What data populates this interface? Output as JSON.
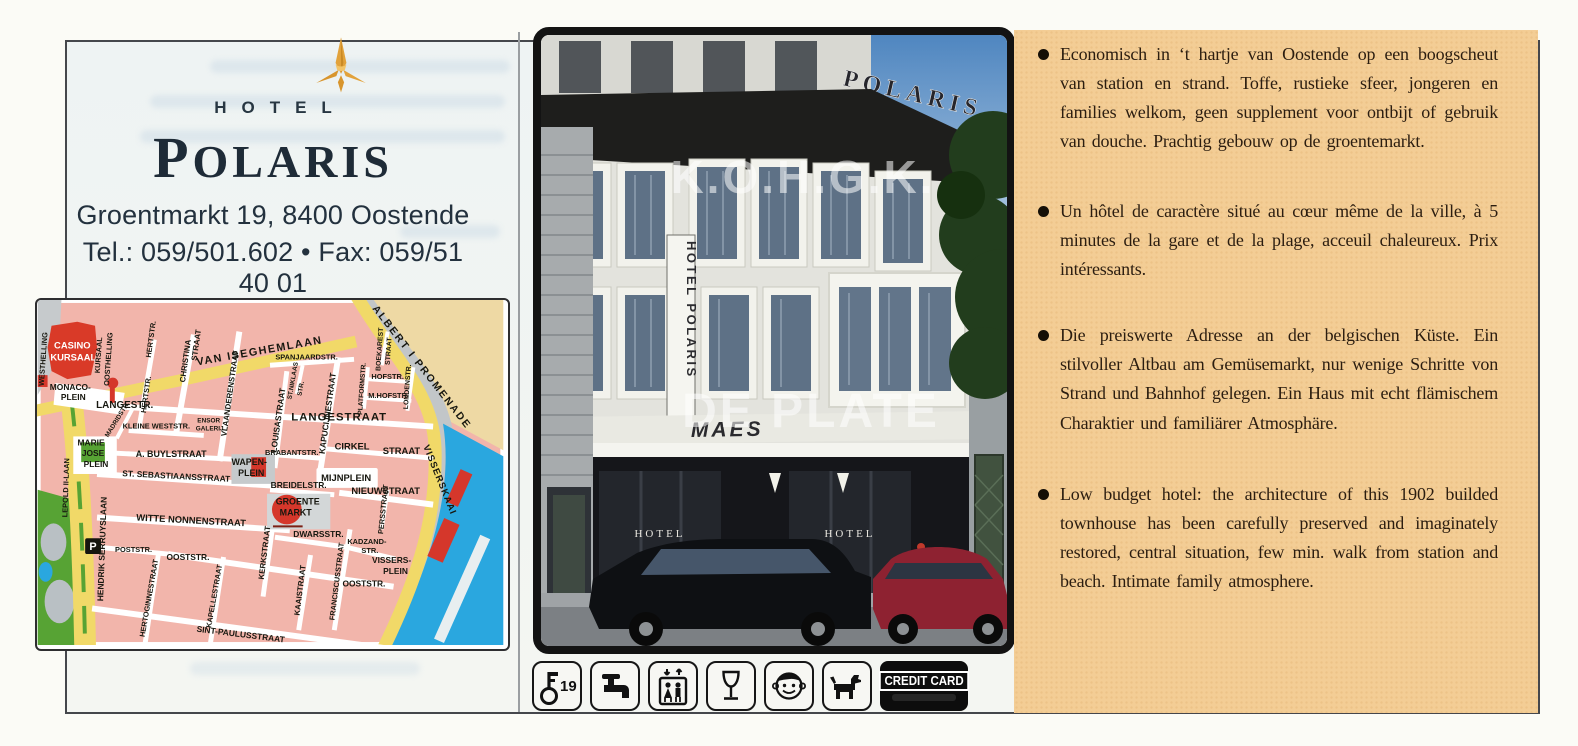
{
  "page": {
    "background": "#fbfbf6",
    "border_color": "#45474c",
    "inner_background": "#f1f5f3"
  },
  "brand": {
    "logo": "gold-star-logo",
    "hotel_label": "HOTEL",
    "name": "POLARIS",
    "address": "Groentmarkt 19, 8400 Oostende",
    "phone_fax": "Tel.: 059/501.602 • Fax: 059/51 40 01",
    "accent_gold": "#e2a23b",
    "navy": "#22303d"
  },
  "map": {
    "colors": {
      "block_pink": "#f2b5ab",
      "road_yellow": "#f1d968",
      "water_blue": "#2aa7df",
      "park_green": "#57a334",
      "landmark_red": "#d5372b",
      "beach_sand": "#eed9a4",
      "promenade_grey": "#c2c6c8"
    },
    "labels": [
      {
        "t": "CASINO",
        "x": 35,
        "y": 49,
        "s": 9.5,
        "c": "#fff"
      },
      {
        "t": "KURSAAL",
        "x": 36,
        "y": 61,
        "s": 9.5,
        "c": "#fff"
      },
      {
        "t": "WESTHELLING",
        "x": 8,
        "y": 60,
        "r": -86,
        "s": 7.5
      },
      {
        "t": "KURSAAL",
        "x": 64,
        "y": 56,
        "r": -86,
        "s": 7.5
      },
      {
        "t": "OOSTHELLING",
        "x": 74,
        "y": 60,
        "r": -86,
        "s": 7.5
      },
      {
        "t": "MONACO-",
        "x": 33,
        "y": 91,
        "s": 8.5
      },
      {
        "t": "PLEIN",
        "x": 36,
        "y": 101,
        "s": 8.5
      },
      {
        "t": "HERTSTR.",
        "x": 117,
        "y": 40,
        "r": -82,
        "s": 7.5
      },
      {
        "t": "HERTSTR.",
        "x": 112,
        "y": 96,
        "r": -82,
        "s": 7.5
      },
      {
        "t": "CHRISTINA",
        "x": 152,
        "y": 62,
        "r": -82,
        "s": 8
      },
      {
        "t": "STRAAT",
        "x": 163,
        "y": 46,
        "r": -82,
        "s": 8
      },
      {
        "t": "VAN ISEGHEMLAAN",
        "x": 225,
        "y": 55,
        "r": -10,
        "s": 11,
        "ls": 1.5
      },
      {
        "t": "ALBERT I PROMENADE",
        "x": 386,
        "y": 70,
        "r": 52,
        "s": 10.5,
        "ls": 2
      },
      {
        "t": "VLAANDERENSTRAAT",
        "x": 197,
        "y": 95,
        "r": -82,
        "s": 8
      },
      {
        "t": "SPANJAARDSTR.",
        "x": 272,
        "y": 60,
        "s": 7.5
      },
      {
        "t": "ST.NIKLAAS",
        "x": 260,
        "y": 82,
        "r": -80,
        "s": 6.5
      },
      {
        "t": "STR.",
        "x": 268,
        "y": 90,
        "r": -80,
        "s": 6.5
      },
      {
        "t": "LANGESTR.",
        "x": 88,
        "y": 109,
        "s": 10
      },
      {
        "t": "LANGESTRAAT",
        "x": 305,
        "y": 122,
        "s": 11.5,
        "ls": 1
      },
      {
        "t": "MADRIDSTR.",
        "x": 82,
        "y": 122,
        "r": -58,
        "s": 6.5
      },
      {
        "t": "KLEINE WESTSTR.",
        "x": 120,
        "y": 130,
        "s": 7.5
      },
      {
        "t": "ENSOR",
        "x": 173,
        "y": 124,
        "s": 6.5
      },
      {
        "t": "GALERIJ",
        "x": 174,
        "y": 132,
        "s": 6.5
      },
      {
        "t": "LOUISASTRAAT",
        "x": 246,
        "y": 122,
        "r": -82,
        "s": 8.5
      },
      {
        "t": "KAPUCIJNESTRAAT",
        "x": 296,
        "y": 115,
        "r": -82,
        "s": 8.5
      },
      {
        "t": "BOEKAREST",
        "x": 348,
        "y": 50,
        "r": -86,
        "s": 7
      },
      {
        "t": "STRAAT",
        "x": 357,
        "y": 52,
        "r": -86,
        "s": 7
      },
      {
        "t": "HOFSTR.",
        "x": 354,
        "y": 80,
        "s": 7.5
      },
      {
        "t": "PLATFORMSTR.",
        "x": 330,
        "y": 90,
        "r": -86,
        "s": 6.8
      },
      {
        "t": "M.HOFSTR.",
        "x": 355,
        "y": 99,
        "s": 7.5
      },
      {
        "t": "LONDENSTR.",
        "x": 376,
        "y": 88,
        "r": -86,
        "s": 7
      },
      {
        "t": "CIRKEL",
        "x": 318,
        "y": 151,
        "s": 9.5
      },
      {
        "t": "STRAAT",
        "x": 368,
        "y": 156,
        "s": 9.5
      },
      {
        "t": "BRABANTSTR.",
        "x": 257,
        "y": 157,
        "s": 7.5
      },
      {
        "t": "MIJNPLEIN",
        "x": 312,
        "y": 183,
        "s": 9.5
      },
      {
        "t": "WAPEN-",
        "x": 214,
        "y": 167,
        "s": 9
      },
      {
        "t": "PLEIN",
        "x": 216,
        "y": 178,
        "s": 9
      },
      {
        "t": "BREIDELSTR.",
        "x": 264,
        "y": 190,
        "s": 8.5
      },
      {
        "t": "NIEUWSTRAAT",
        "x": 352,
        "y": 196,
        "s": 9.5
      },
      {
        "t": "PERSSTRAAT",
        "x": 352,
        "y": 212,
        "r": -84,
        "s": 7.5
      },
      {
        "t": "GROENTE",
        "x": 263,
        "y": 207,
        "s": 9
      },
      {
        "t": "MARKT",
        "x": 261,
        "y": 218,
        "s": 9
      },
      {
        "t": "DWARSSTR.",
        "x": 284,
        "y": 240,
        "s": 8.5
      },
      {
        "t": "KADZAND-",
        "x": 333,
        "y": 247,
        "s": 7.5
      },
      {
        "t": "STR.",
        "x": 336,
        "y": 256,
        "s": 7.5
      },
      {
        "t": "VISSERS-",
        "x": 358,
        "y": 266,
        "s": 8.5
      },
      {
        "t": "PLEIN",
        "x": 362,
        "y": 277,
        "s": 8.5
      },
      {
        "t": "OOSTSTR.",
        "x": 330,
        "y": 290,
        "s": 8.5
      },
      {
        "t": "FRANCISCUSSTRAAT",
        "x": 305,
        "y": 285,
        "r": -83,
        "s": 7.5
      },
      {
        "t": "KAAISTRAAT",
        "x": 268,
        "y": 294,
        "r": -83,
        "s": 8
      },
      {
        "t": "KERKSTRAAT",
        "x": 232,
        "y": 256,
        "r": -83,
        "s": 8
      },
      {
        "t": "ST. SEBASTIAANSSTRAAT",
        "x": 140,
        "y": 181,
        "r": 3,
        "s": 8.5
      },
      {
        "t": "WITTE NONNENSTRAAT",
        "x": 155,
        "y": 226,
        "r": 3,
        "s": 9.5
      },
      {
        "t": "LEPOLD II-LAAN",
        "x": 31,
        "y": 190,
        "r": -88,
        "s": 7.5
      },
      {
        "t": "HENDRIK SERRUYSLAAN",
        "x": 68,
        "y": 252,
        "r": -88,
        "s": 8.5
      },
      {
        "t": "MARIE",
        "x": 54,
        "y": 147,
        "s": 8.5
      },
      {
        "t": "JOSE",
        "x": 56,
        "y": 158,
        "s": 8.5
      },
      {
        "t": "PLEIN",
        "x": 59,
        "y": 169,
        "s": 8.5
      },
      {
        "t": "A. BUYLSTRAAT",
        "x": 135,
        "y": 159,
        "s": 9
      },
      {
        "t": "POSTSTR.",
        "x": 97,
        "y": 255,
        "s": 7.5
      },
      {
        "t": "OOSTSTR.",
        "x": 152,
        "y": 263,
        "s": 8.5
      },
      {
        "t": "HERTOGINNESTRAAT",
        "x": 115,
        "y": 302,
        "r": -80,
        "s": 7.5
      },
      {
        "t": "KAPELLESTRAAT",
        "x": 181,
        "y": 300,
        "r": -80,
        "s": 7.5
      },
      {
        "t": "SINT-PAULUSSTRAAT",
        "x": 205,
        "y": 341,
        "r": 7,
        "s": 8.5
      },
      {
        "t": "VISSERSKAAI",
        "x": 404,
        "y": 183,
        "r": 68,
        "s": 9.5,
        "ls": 1
      },
      {
        "t": "P",
        "x": 56,
        "y": 253,
        "s": 11,
        "c": "#fff"
      }
    ]
  },
  "photo": {
    "rooftop_sign": "POLARIS",
    "vertical_sign": "HOTEL POLARIS",
    "awning_sign": "MAES",
    "storefront_sign_left": "HOTEL",
    "storefront_sign_right": "HOTEL",
    "watermark_line1": "K.O.H.G.K.",
    "watermark_line2": "DE PLATE"
  },
  "description_panel": {
    "background": "#f3cd95",
    "bullets": [
      {
        "lang": "nl",
        "text": "Economisch in ‘t hartje van Oostende op een boogscheut van station en strand. Toffe, rustieke sfeer, jongeren en families welkom, geen supplement voor ontbijt of gebruik van douche. Prachtig gebouw op de groentemarkt."
      },
      {
        "lang": "fr",
        "text": "Un hôtel de caractère situé au cœur même de la ville, à 5 minutes de la gare et de la plage, acceuil chaleureux. Prix intéressants."
      },
      {
        "lang": "de",
        "text": "Die preiswerte Adresse an der belgischen Küste. Ein stilvoller Altbau am Gemüsemarkt, nur wenige Schritte von Strand und Bahnhof gelegen. Ein Haus mit echt flämischem Charaktier und familiärer Atmosphäre."
      },
      {
        "lang": "en",
        "text": "Low budget hotel: the architecture of this 1902 builded townhouse has been carefully preserved and imaginately restored, central situation, few min. walk from station and beach. Intimate family atmosphere."
      }
    ]
  },
  "amenities": {
    "items": [
      {
        "icon": "room-key-icon",
        "label": "19"
      },
      {
        "icon": "faucet-icon",
        "label": ""
      },
      {
        "icon": "elevator-icon",
        "label": ""
      },
      {
        "icon": "wine-glass-icon",
        "label": ""
      },
      {
        "icon": "children-welcome-icon",
        "label": ""
      },
      {
        "icon": "pets-allowed-icon",
        "label": ""
      },
      {
        "icon": "credit-card-icon",
        "label": "CREDIT CARD"
      }
    ]
  }
}
